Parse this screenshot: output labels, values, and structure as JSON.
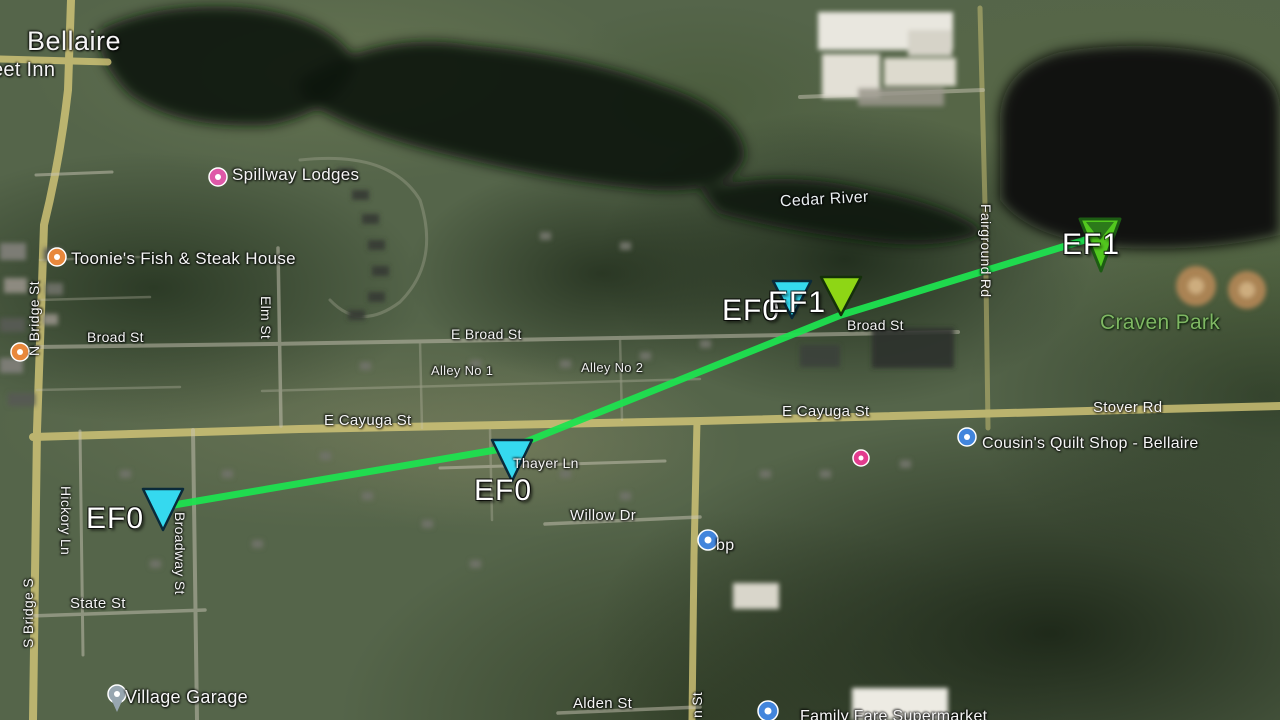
{
  "places": {
    "town": "Bellaire",
    "inn_partial": "eet Inn",
    "spillway": "Spillway Lodges",
    "toonies": "Toonie's Fish & Steak House",
    "cedar_river": "Cedar River",
    "craven_park": "Craven Park",
    "cousins": "Cousin's Quilt Shop - Bellaire",
    "bp": "bp",
    "village_garage": "Village Garage",
    "family_fare": "Family Fare Supermarket"
  },
  "streets": {
    "n_bridge": "N Bridge St",
    "s_bridge": "S Bridge S",
    "broad_w": "Broad St",
    "broad_e": "Broad St",
    "e_broad": "E Broad St",
    "alley_1": "Alley No 1",
    "alley_2": "Alley No 2",
    "e_cayuga_west": "E Cayuga St",
    "e_cayuga_east": "E Cayuga St",
    "stover": "Stover Rd",
    "thayer": "Thayer Ln",
    "willow": "Willow Dr",
    "state": "State St",
    "alden": "Alden St",
    "hickory": "Hickory Ln",
    "broadway": "Broadway St",
    "elm": "Elm St",
    "fairground": "Fairground Rd",
    "n_st_partial": "n St"
  },
  "damage_markers": [
    {
      "id": "track-start-southwest",
      "rating": "EF0"
    },
    {
      "id": "thayer-ln",
      "rating": "EF0"
    },
    {
      "id": "east-broad-cyan",
      "rating": "EF0"
    },
    {
      "id": "east-broad-green",
      "rating": "EF1"
    },
    {
      "id": "track-end-craven-park",
      "rating": "EF1"
    }
  ],
  "colors": {
    "tornado_path": "#1ee24f",
    "ef0_marker": "#35d9ef",
    "ef1_marker": "#8ed615",
    "ef1_end_marker": "#52c81e",
    "road_primary": "#d9cb7a",
    "road_secondary": "#c9c4b4",
    "park_label": "#7fb763",
    "pins": {
      "lodging": "#df58a8",
      "restaurant": "#e8883c",
      "blue": "#4285dc",
      "gray": "#97a6b0",
      "pink": "#e23c8e"
    }
  }
}
